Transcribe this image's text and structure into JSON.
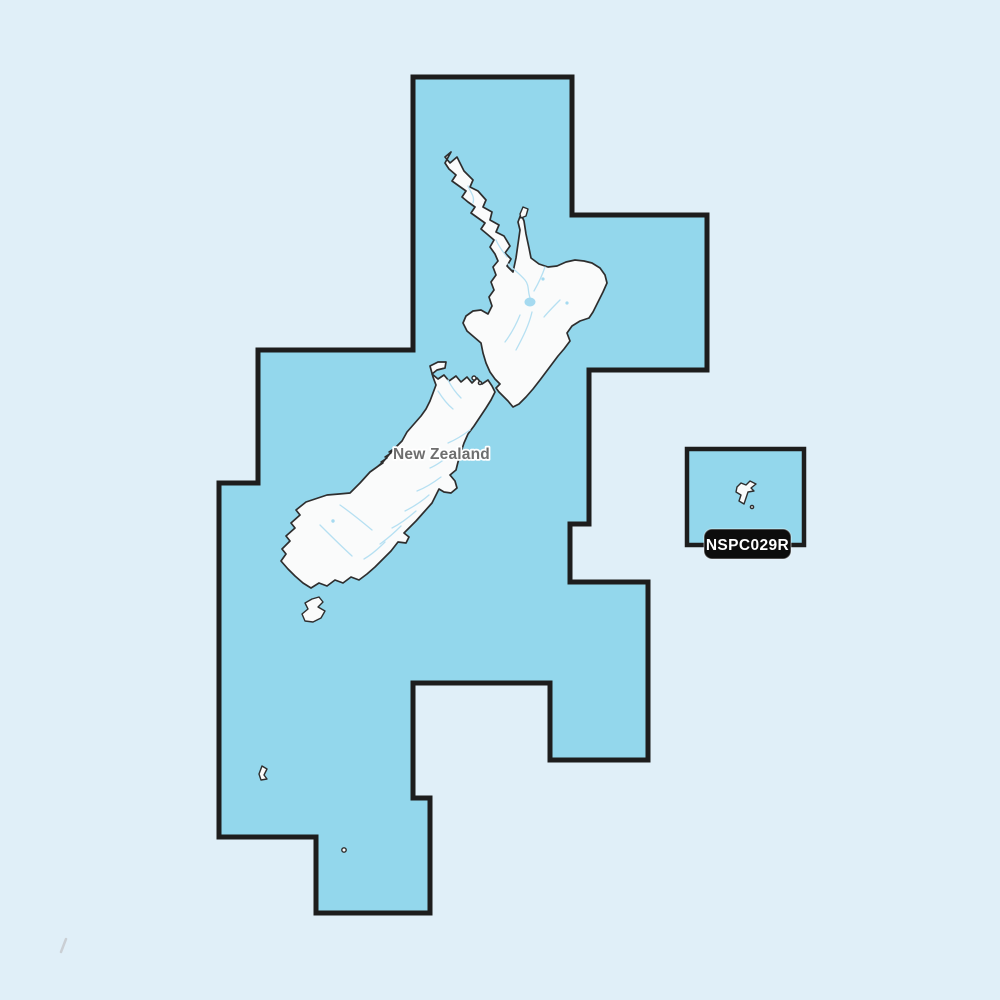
{
  "map": {
    "country_label": "New Zealand",
    "chart_code": "NSPC029R",
    "regions": {
      "main_coverage": "New Zealand mainland coverage polygon",
      "secondary_coverage": "Chatham Islands coverage box"
    },
    "colors": {
      "background": "#e0eff8",
      "coverage_fill": "#93d7ec",
      "coverage_border": "#1d1d1d",
      "land_fill": "#fafbfb",
      "land_outline": "#2e2e2e",
      "river": "#b6e0f2",
      "lake": "#a5daf0",
      "label_text": "#6e6e6e",
      "badge_bg": "#0d0d0d",
      "badge_text": "#ffffff"
    }
  }
}
